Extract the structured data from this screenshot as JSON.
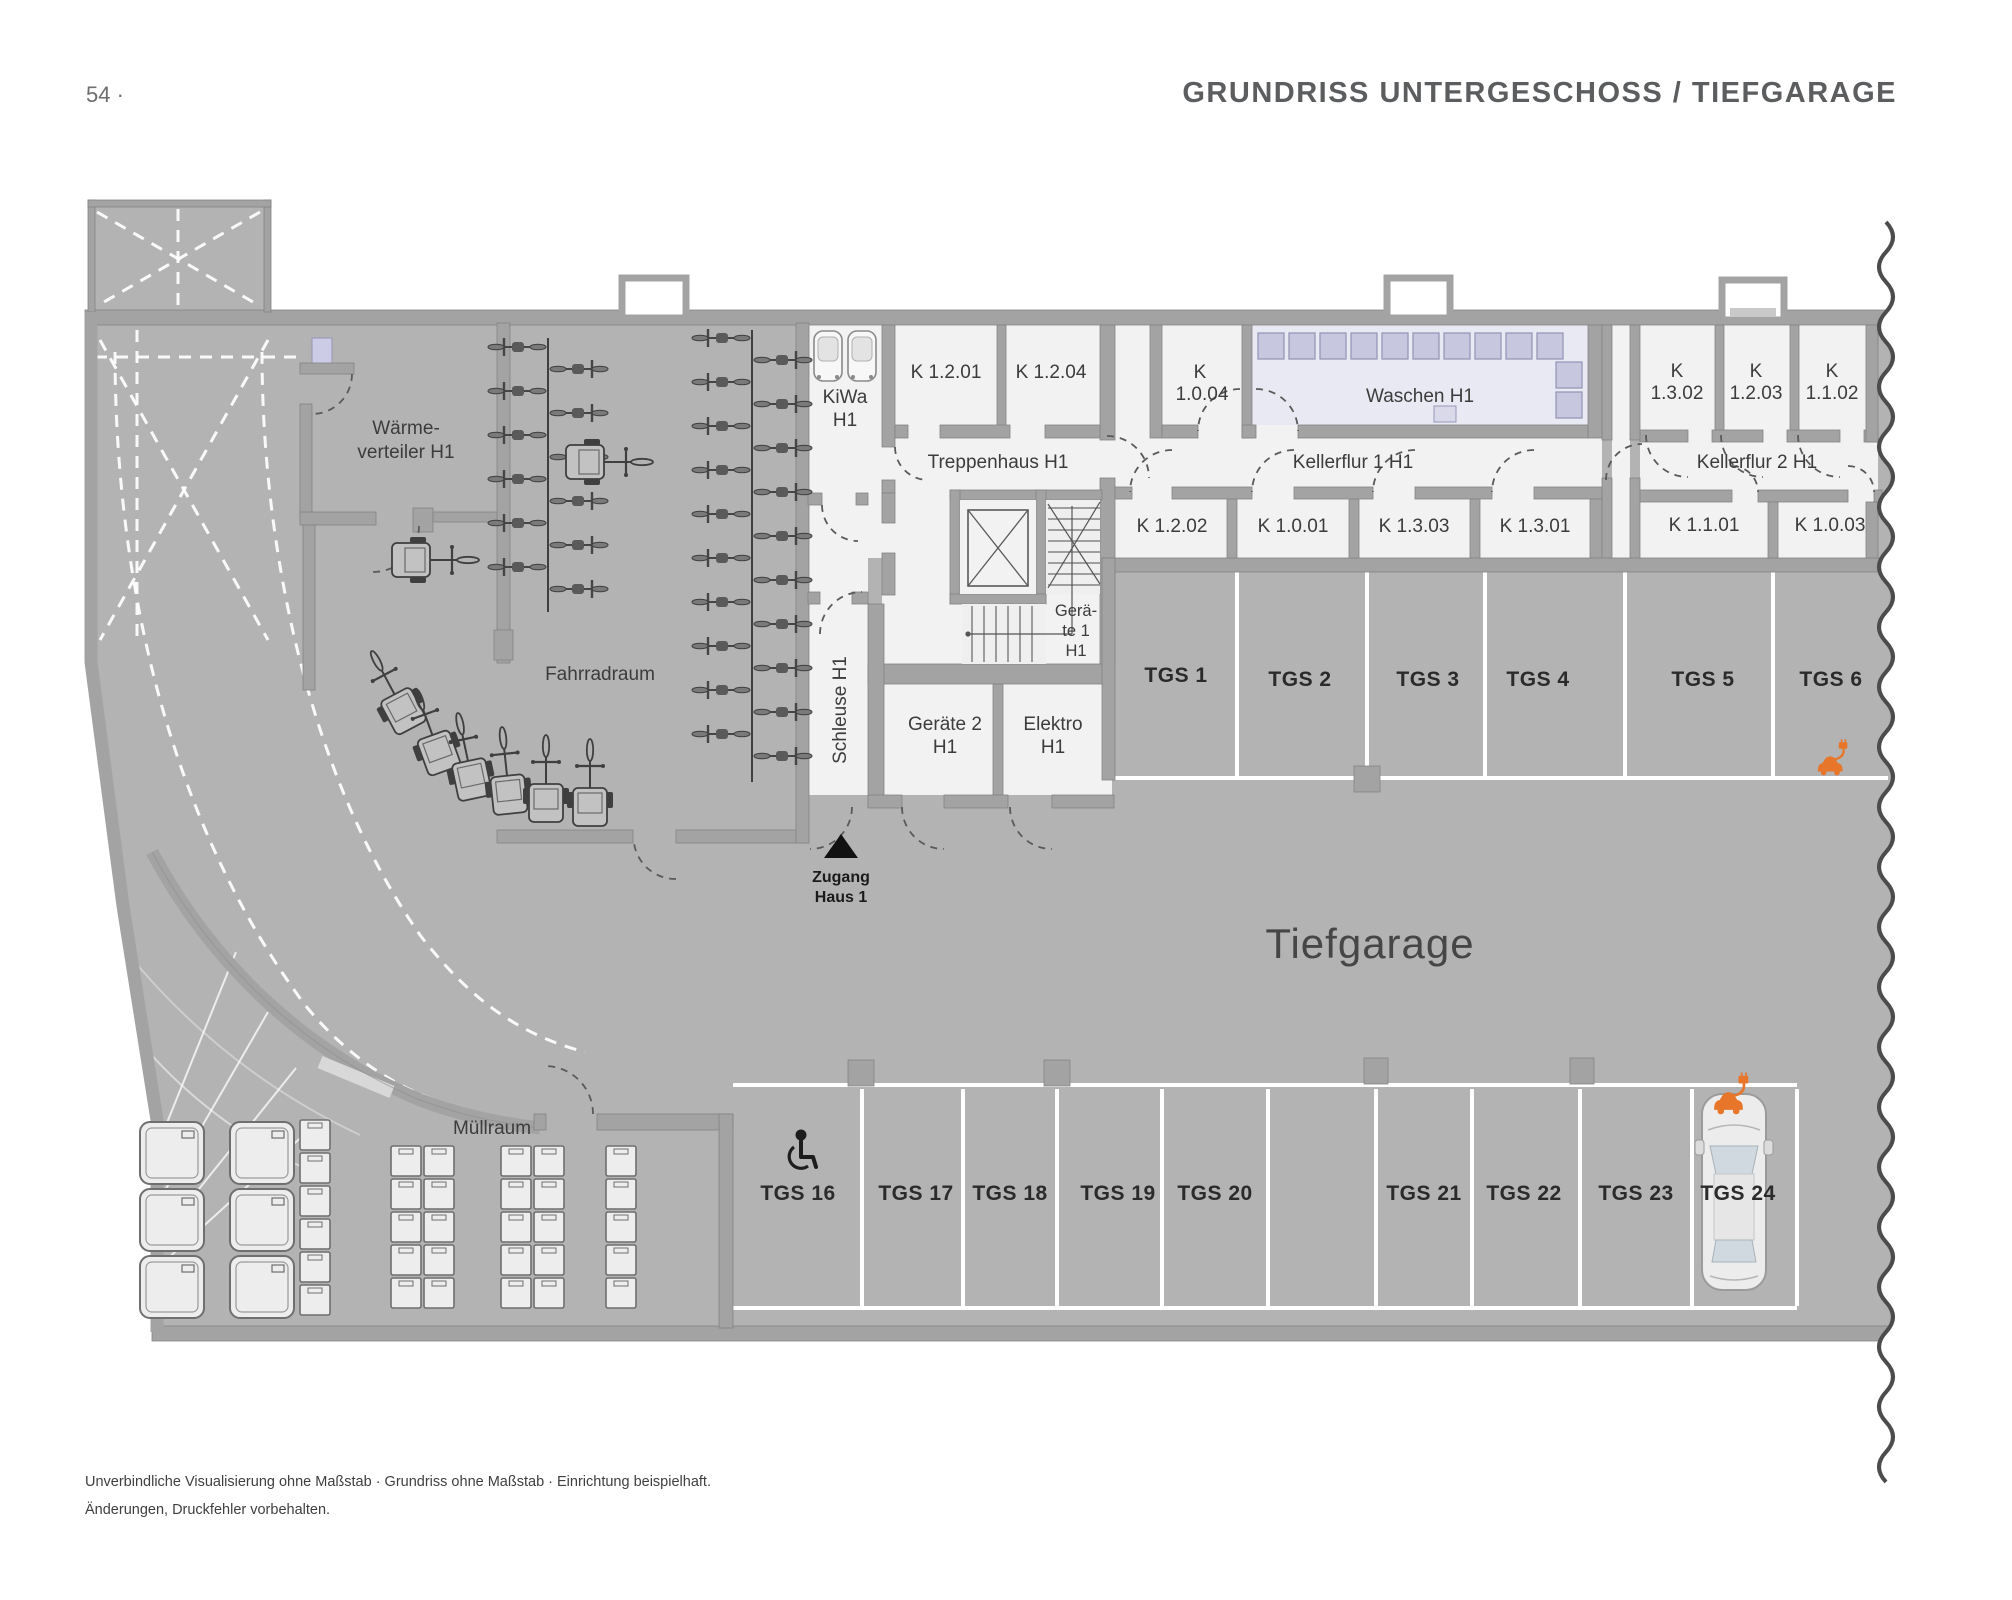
{
  "header": {
    "page_number": "54 ·",
    "title": "GRUNDRISS UNTERGESCHOSS / TIEFGARAGE"
  },
  "plan": {
    "rooms": {
      "waermeverteiler": {
        "line1": "Wärme-",
        "line2": "verteiler H1"
      },
      "fahrradraum": "Fahrradraum",
      "kiwa": {
        "line1": "KiWa",
        "line2": "H1"
      },
      "k1201": "K 1.2.01",
      "k1204": "K 1.2.04",
      "treppenhaus": "Treppenhaus H1",
      "k1004": {
        "line1": "K",
        "line2": "1.0.04"
      },
      "waschen": "Waschen H1",
      "kellerflur1": "Kellerflur 1 H1",
      "k1302": {
        "line1": "K",
        "line2": "1.3.02"
      },
      "k1203": {
        "line1": "K",
        "line2": "1.2.03"
      },
      "k1102": {
        "line1": "K",
        "line2": "1.1.02"
      },
      "kellerflur2": "Kellerflur 2 H1",
      "k1202": "K 1.2.02",
      "k1001": "K 1.0.01",
      "k1303": "K 1.3.03",
      "k1301": "K 1.3.01",
      "k1101": "K 1.1.01",
      "k1003": "K 1.0.03",
      "geraete1": {
        "line1": "Gerä-",
        "line2": "te 1",
        "line3": "H1"
      },
      "schleuse": "Schleuse H1",
      "geraete2": {
        "line1": "Geräte 2",
        "line2": "H1"
      },
      "elektro": {
        "line1": "Elektro",
        "line2": "H1"
      },
      "muellraum": "Müllraum",
      "tiefgarage": "Tiefgarage"
    },
    "access": {
      "line1": "Zugang",
      "line2": "Haus 1"
    },
    "tgs_top": [
      "TGS 1",
      "TGS 2",
      "TGS 3",
      "TGS 4",
      "TGS 5",
      "TGS 6"
    ],
    "tgs_bottom": [
      "TGS 16",
      "TGS 17",
      "TGS 18",
      "TGS 19",
      "TGS 20",
      "TGS 21",
      "TGS 22",
      "TGS 23",
      "TGS 24"
    ],
    "colors": {
      "floor": "#b3b3b3",
      "wall": "#a3a3a3",
      "room": "#f2f2f2",
      "laundry_room": "#e9e9f3",
      "appliance": "#c7c7df",
      "ev_accent": "#e8762a",
      "break_line": "#4c4c4c"
    }
  },
  "footer": {
    "line1": "Unverbindliche Visualisierung ohne Maßstab · Grundriss ohne Maßstab · Einrichtung beispielhaft.",
    "line2": "Änderungen, Druckfehler vorbehalten."
  }
}
